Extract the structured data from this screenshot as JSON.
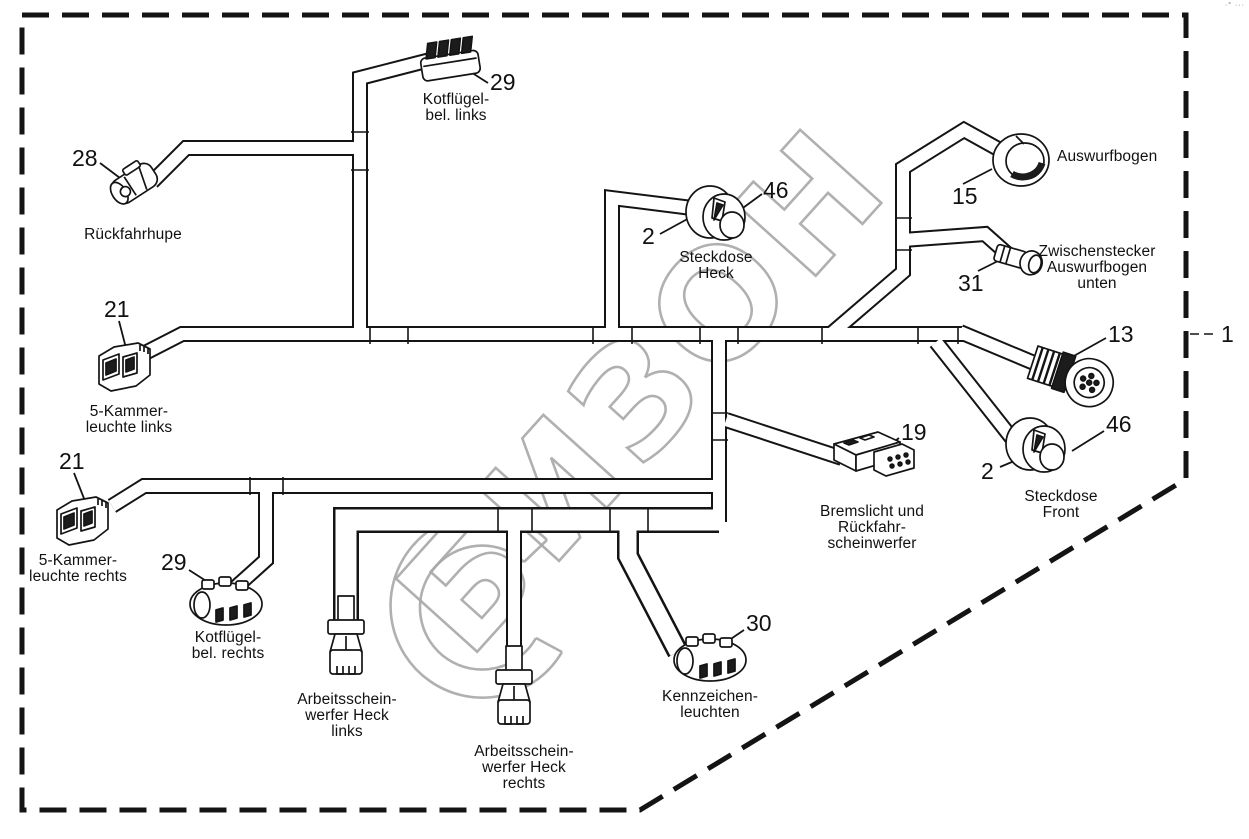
{
  "watermark": {
    "text": "БИЗОН",
    "color": "#a8a8a8"
  },
  "corner_mark": "·° ···",
  "colors": {
    "line": "#141414",
    "background": "#ffffff",
    "watermark": "#a8a8a8"
  },
  "parts": {
    "harness_ref": {
      "num": "1"
    },
    "rueckfahrhupe": {
      "num": "28",
      "lines": [
        "Rückfahrhupe"
      ]
    },
    "kotfluegel_links": {
      "num": "29",
      "lines": [
        "Kotflügel-",
        "bel. links"
      ]
    },
    "steckdose_heck": {
      "num_socket": "2",
      "num_cap": "46",
      "lines": [
        "Steckdose",
        "Heck"
      ]
    },
    "auswurfbogen": {
      "num": "15",
      "lines": [
        "Auswurfbogen"
      ]
    },
    "zwischenstecker": {
      "num": "31",
      "lines": [
        "Zwischenstecker",
        "Auswurfbogen",
        "unten"
      ]
    },
    "rundstecker": {
      "num": "13"
    },
    "steckdose_front": {
      "num_socket": "2",
      "num_cap": "46",
      "lines": [
        "Steckdose",
        "Front"
      ]
    },
    "kammerleuchte_links": {
      "num": "21",
      "lines": [
        "5-Kammer-",
        "leuchte links"
      ]
    },
    "kammerleuchte_rechts": {
      "num": "21",
      "lines": [
        "5-Kammer-",
        "leuchte rechts"
      ]
    },
    "kotfluegel_rechts": {
      "num": "29",
      "lines": [
        "Kotflügel-",
        "bel. rechts"
      ]
    },
    "arbeitsscheinwerfer_links": {
      "lines": [
        "Arbeitsschein-",
        "werfer Heck",
        "links"
      ]
    },
    "arbeitsscheinwerfer_rechts": {
      "lines": [
        "Arbeitsschein-",
        "werfer Heck",
        "rechts"
      ]
    },
    "kennzeichenleuchten": {
      "num": "30",
      "lines": [
        "Kennzeichen-",
        "leuchten"
      ]
    },
    "bremslicht": {
      "num": "19",
      "lines": [
        "Bremslicht und",
        "Rückfahr-",
        "scheinwerfer"
      ]
    }
  }
}
